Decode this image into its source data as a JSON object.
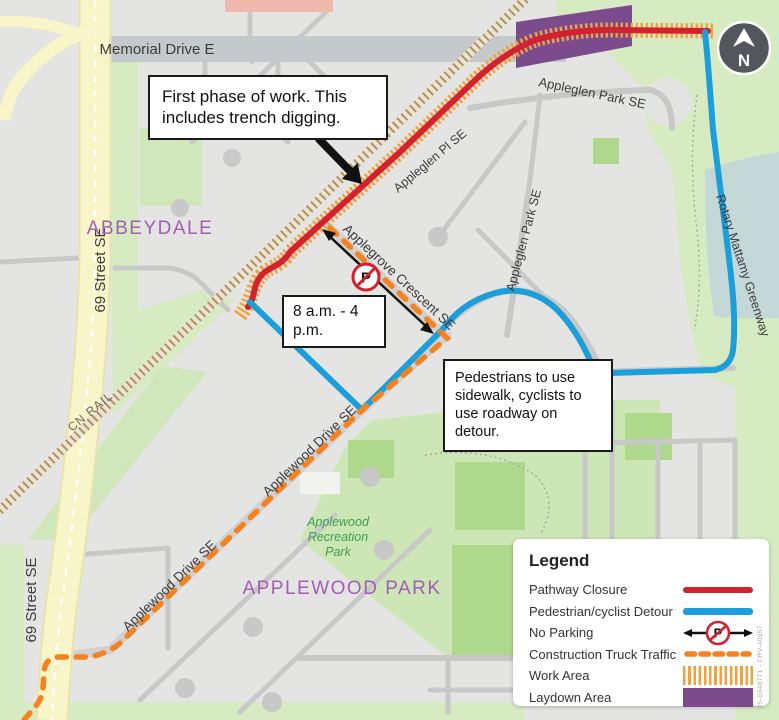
{
  "map": {
    "region_labels": {
      "abbeydale": "ABBEYDALE",
      "applewood_park": "APPLEWOOD PARK"
    },
    "street_labels": {
      "memorial_drive": "Memorial Drive E",
      "street_69_upper": "69 Street SE",
      "street_69_lower": "69 Street SE",
      "cn_rail": "CN RAIL",
      "appleglen_park_top": "Appleglen Park SE",
      "appleglen_pl": "Appleglen Pl SE",
      "appleglen_park_side": "Appleglen Park SE",
      "applegrove_crescent": "Applegrove Crescent SE",
      "rotary_greenway": "Rotary Mattamy Greenway",
      "applewood_drive_upper": "Applewood Drive SE",
      "applewood_drive_lower": "Applewood Drive SE"
    },
    "park_labels": {
      "rec_line1": "Applewood",
      "rec_line2": "Recreation",
      "rec_line3": "Park"
    },
    "compass_label": "N",
    "no_parking_letter": "P",
    "reference": "25-0048771 - CRV-40957"
  },
  "callouts": {
    "first_phase": "First phase of work. This includes trench digging.",
    "hours": "8 a.m. - 4 p.m.",
    "pedestrians": "Pedestrians to use sidewalk, cyclists to use roadway on detour."
  },
  "legend": {
    "title": "Legend",
    "items": [
      {
        "label": "Pathway Closure"
      },
      {
        "label": "Pedestrian/cyclist Detour"
      },
      {
        "label": "No Parking"
      },
      {
        "label": "Construction Truck Traffic"
      },
      {
        "label": "Work Area"
      },
      {
        "label": "Laydown Area"
      }
    ]
  },
  "colors": {
    "pathway_closure": "#d4212e",
    "detour": "#1b9ed9",
    "truck_traffic": "#f58220",
    "work_area": "#f2a13f",
    "laydown_area": "#7b4b8e"
  }
}
